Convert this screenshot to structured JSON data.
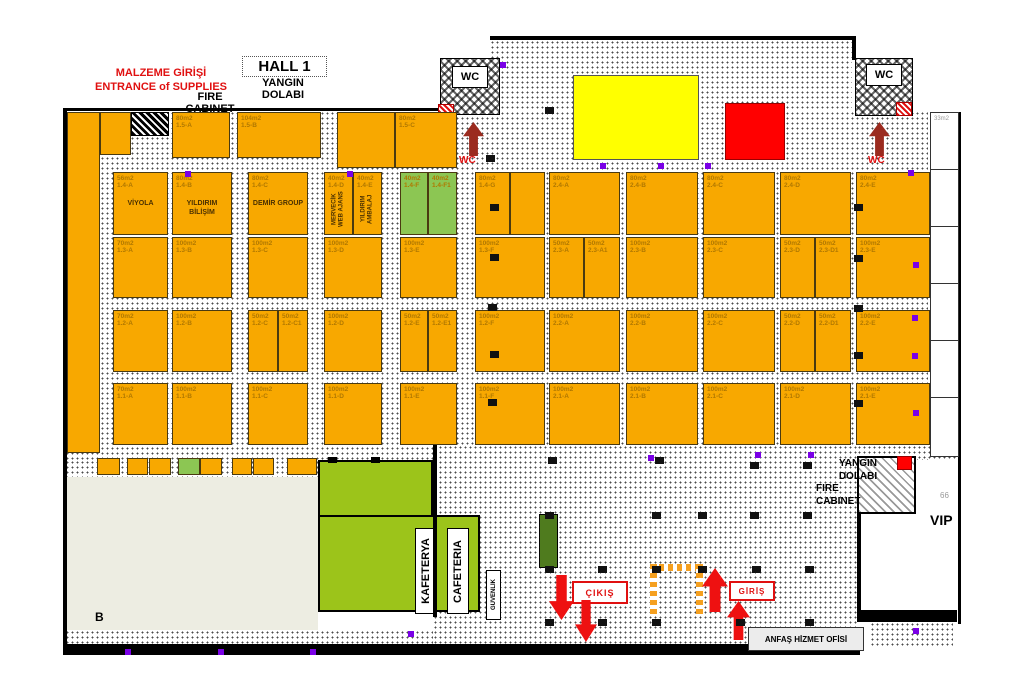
{
  "header": {
    "hall_title": "HALL 1",
    "yangin": "YANGIN",
    "dolabi": "DOLABI",
    "malzeme_line1": "MALZEME GİRİŞİ",
    "malzeme_line2": "ENTRANCE of SUPPLIES",
    "fire_line1": "FIRE",
    "fire_line2": "CABINET"
  },
  "labels": {
    "wc_left": "WC",
    "wc_right": "WC",
    "wc_red_left": "WC",
    "wc_red_right": "WC",
    "yangin_br_1": "YANGIN",
    "yangin_br_2": "DOLABI",
    "yangin_br_3": "FIRE",
    "yangin_br_4": "CABINET",
    "vip": "VIP",
    "dim_66": "66",
    "room_33": "33m2",
    "cikis": "ÇIKIŞ",
    "giris": "GİRİŞ",
    "kafeterya": "KAFETERYA",
    "cafeteria": "CAFETERIA",
    "guvenlik": "GÜVENLİK",
    "anfas_office": "ANFAŞ HİZMET OFİSİ",
    "section_b": "B"
  },
  "colors": {
    "booth_orange": "#F8A800",
    "booth_green": "#8CC653",
    "cafeteria_green": "#9CC41A",
    "kiosk_green": "#4F7B1E",
    "beige_hall": "#EDEDE2",
    "yellow_block": "#FFFF00",
    "red_block": "#FF0000",
    "arrow_red": "#EE1111",
    "arrow_darkred": "#9B2B1F",
    "purple_marker": "#7A00E6"
  },
  "booths": [
    {
      "x": 67,
      "y": 112,
      "w": 33,
      "h": 341
    },
    {
      "x": 100,
      "y": 112,
      "w": 31,
      "h": 43
    },
    {
      "x": 172,
      "y": 112,
      "w": 58,
      "h": 46,
      "size": "80m2",
      "code": "1.5-A"
    },
    {
      "x": 237,
      "y": 112,
      "w": 84,
      "h": 46,
      "size": "104m2",
      "code": "1.5-B"
    },
    {
      "x": 337,
      "y": 112,
      "w": 58,
      "h": 56
    },
    {
      "x": 395,
      "y": 112,
      "w": 62,
      "h": 56,
      "size": "80m2",
      "code": "1.5-C"
    },
    {
      "x": 113,
      "y": 172,
      "w": 55,
      "h": 63,
      "size": "56m2",
      "code": "1.4-A",
      "name": "VİYOLA"
    },
    {
      "x": 172,
      "y": 172,
      "w": 60,
      "h": 63,
      "size": "80m2",
      "code": "1.4-B",
      "name": "YILDIRIM BİLİŞİM"
    },
    {
      "x": 248,
      "y": 172,
      "w": 60,
      "h": 63,
      "size": "80m2",
      "code": "1.4-C",
      "name": "DEMİR GROUP"
    },
    {
      "x": 324,
      "y": 172,
      "w": 29,
      "h": 63,
      "size": "40m2",
      "code": "1.4-D",
      "name": "MERVECİK WEB AJANS",
      "vert": true
    },
    {
      "x": 353,
      "y": 172,
      "w": 29,
      "h": 63,
      "size": "40m2",
      "code": "1.4-E",
      "name": "YILDIRIM AMBALAJ",
      "vert": true
    },
    {
      "x": 400,
      "y": 172,
      "w": 28,
      "h": 63,
      "size": "40m2",
      "code": "1.4-F",
      "green": true
    },
    {
      "x": 428,
      "y": 172,
      "w": 29,
      "h": 63,
      "size": "40m2",
      "code": "1.4-F1",
      "green": true
    },
    {
      "x": 475,
      "y": 172,
      "w": 35,
      "h": 63,
      "size": "80m2",
      "code": "1.4-G"
    },
    {
      "x": 510,
      "y": 172,
      "w": 35,
      "h": 63
    },
    {
      "x": 549,
      "y": 172,
      "w": 71,
      "h": 63,
      "size": "80m2",
      "code": "2.4-A"
    },
    {
      "x": 626,
      "y": 172,
      "w": 72,
      "h": 63,
      "size": "80m2",
      "code": "2.4-B"
    },
    {
      "x": 703,
      "y": 172,
      "w": 72,
      "h": 63,
      "size": "80m2",
      "code": "2.4-C"
    },
    {
      "x": 780,
      "y": 172,
      "w": 71,
      "h": 63,
      "size": "80m2",
      "code": "2.4-D"
    },
    {
      "x": 856,
      "y": 172,
      "w": 74,
      "h": 63,
      "size": "80m2",
      "code": "2.4-E"
    },
    {
      "x": 113,
      "y": 237,
      "w": 55,
      "h": 61,
      "size": "70m2",
      "code": "1.3-A"
    },
    {
      "x": 172,
      "y": 237,
      "w": 60,
      "h": 61,
      "size": "100m2",
      "code": "1.3-B"
    },
    {
      "x": 248,
      "y": 237,
      "w": 60,
      "h": 61,
      "size": "100m2",
      "code": "1.3-C"
    },
    {
      "x": 324,
      "y": 237,
      "w": 58,
      "h": 61,
      "size": "100m2",
      "code": "1.3-D"
    },
    {
      "x": 400,
      "y": 237,
      "w": 57,
      "h": 61,
      "size": "100m2",
      "code": "1.3-E"
    },
    {
      "x": 475,
      "y": 237,
      "w": 70,
      "h": 61,
      "size": "100m2",
      "code": "1.3-F"
    },
    {
      "x": 549,
      "y": 237,
      "w": 35,
      "h": 61,
      "size": "50m2",
      "code": "2.3-A"
    },
    {
      "x": 584,
      "y": 237,
      "w": 36,
      "h": 61,
      "size": "50m2",
      "code": "2.3-A1"
    },
    {
      "x": 626,
      "y": 237,
      "w": 72,
      "h": 61,
      "size": "100m2",
      "code": "2.3-B"
    },
    {
      "x": 703,
      "y": 237,
      "w": 72,
      "h": 61,
      "size": "100m2",
      "code": "2.3-C"
    },
    {
      "x": 780,
      "y": 237,
      "w": 35,
      "h": 61,
      "size": "50m2",
      "code": "2.3-D"
    },
    {
      "x": 815,
      "y": 237,
      "w": 36,
      "h": 61,
      "size": "50m2",
      "code": "2.3-D1"
    },
    {
      "x": 856,
      "y": 237,
      "w": 74,
      "h": 61,
      "size": "100m2",
      "code": "2.3-E"
    },
    {
      "x": 113,
      "y": 310,
      "w": 55,
      "h": 62,
      "size": "70m2",
      "code": "1.2-A"
    },
    {
      "x": 172,
      "y": 310,
      "w": 60,
      "h": 62,
      "size": "100m2",
      "code": "1.2-B"
    },
    {
      "x": 248,
      "y": 310,
      "w": 30,
      "h": 62,
      "size": "50m2",
      "code": "1.2-C"
    },
    {
      "x": 278,
      "y": 310,
      "w": 30,
      "h": 62,
      "size": "50m2",
      "code": "1.2-C1"
    },
    {
      "x": 324,
      "y": 310,
      "w": 58,
      "h": 62,
      "size": "100m2",
      "code": "1.2-D"
    },
    {
      "x": 400,
      "y": 310,
      "w": 28,
      "h": 62,
      "size": "50m2",
      "code": "1.2-E"
    },
    {
      "x": 428,
      "y": 310,
      "w": 29,
      "h": 62,
      "size": "50m2",
      "code": "1.2-E1"
    },
    {
      "x": 475,
      "y": 310,
      "w": 70,
      "h": 62,
      "size": "100m2",
      "code": "1.2-F"
    },
    {
      "x": 549,
      "y": 310,
      "w": 71,
      "h": 62,
      "size": "100m2",
      "code": "2.2-A"
    },
    {
      "x": 626,
      "y": 310,
      "w": 72,
      "h": 62,
      "size": "100m2",
      "code": "2.2-B"
    },
    {
      "x": 703,
      "y": 310,
      "w": 72,
      "h": 62,
      "size": "100m2",
      "code": "2.2-C"
    },
    {
      "x": 780,
      "y": 310,
      "w": 35,
      "h": 62,
      "size": "50m2",
      "code": "2.2-D"
    },
    {
      "x": 815,
      "y": 310,
      "w": 36,
      "h": 62,
      "size": "50m2",
      "code": "2.2-D1"
    },
    {
      "x": 856,
      "y": 310,
      "w": 74,
      "h": 62,
      "size": "100m2",
      "code": "2.2-E"
    },
    {
      "x": 113,
      "y": 383,
      "w": 55,
      "h": 62,
      "size": "70m2",
      "code": "1.1-A"
    },
    {
      "x": 172,
      "y": 383,
      "w": 60,
      "h": 62,
      "size": "100m2",
      "code": "1.1-B"
    },
    {
      "x": 248,
      "y": 383,
      "w": 60,
      "h": 62,
      "size": "100m2",
      "code": "1.1-C"
    },
    {
      "x": 324,
      "y": 383,
      "w": 58,
      "h": 62,
      "size": "100m2",
      "code": "1.1-D"
    },
    {
      "x": 400,
      "y": 383,
      "w": 57,
      "h": 62,
      "size": "100m2",
      "code": "1.1-E"
    },
    {
      "x": 475,
      "y": 383,
      "w": 70,
      "h": 62,
      "size": "100m2",
      "code": "1.1-F"
    },
    {
      "x": 549,
      "y": 383,
      "w": 71,
      "h": 62,
      "size": "100m2",
      "code": "2.1-A"
    },
    {
      "x": 626,
      "y": 383,
      "w": 72,
      "h": 62,
      "size": "100m2",
      "code": "2.1-B"
    },
    {
      "x": 703,
      "y": 383,
      "w": 72,
      "h": 62,
      "size": "100m2",
      "code": "2.1-C"
    },
    {
      "x": 780,
      "y": 383,
      "w": 71,
      "h": 62,
      "size": "100m2",
      "code": "2.1-D"
    },
    {
      "x": 856,
      "y": 383,
      "w": 74,
      "h": 62,
      "size": "100m2",
      "code": "2.1-E"
    },
    {
      "x": 97,
      "y": 458,
      "w": 23,
      "h": 17
    },
    {
      "x": 127,
      "y": 458,
      "w": 21,
      "h": 17
    },
    {
      "x": 149,
      "y": 458,
      "w": 22,
      "h": 17
    },
    {
      "x": 178,
      "y": 458,
      "w": 22,
      "h": 17,
      "green": true
    },
    {
      "x": 200,
      "y": 458,
      "w": 22,
      "h": 17
    },
    {
      "x": 232,
      "y": 458,
      "w": 20,
      "h": 17
    },
    {
      "x": 253,
      "y": 458,
      "w": 21,
      "h": 17
    },
    {
      "x": 287,
      "y": 458,
      "w": 30,
      "h": 17
    }
  ],
  "arrows": [
    {
      "x": 549,
      "y": 575,
      "w": 25,
      "h": 45,
      "dir": "down",
      "color": "#EE1111",
      "name": "exit-arrow-down-1"
    },
    {
      "x": 575,
      "y": 600,
      "w": 22,
      "h": 42,
      "dir": "down",
      "color": "#EE1111",
      "name": "exit-arrow-down-2"
    },
    {
      "x": 702,
      "y": 568,
      "w": 26,
      "h": 44,
      "dir": "up",
      "color": "#EE1111",
      "name": "entry-arrow-up-1"
    },
    {
      "x": 727,
      "y": 601,
      "w": 23,
      "h": 39,
      "dir": "up",
      "color": "#EE1111",
      "name": "entry-arrow-up-2"
    },
    {
      "x": 463,
      "y": 122,
      "w": 21,
      "h": 34,
      "dir": "up",
      "color": "#9B2B1F",
      "name": "wc-arrow-left"
    },
    {
      "x": 869,
      "y": 122,
      "w": 21,
      "h": 34,
      "dir": "up",
      "color": "#9B2B1F",
      "name": "wc-arrow-right"
    }
  ],
  "pillars": [
    [
      545,
      107
    ],
    [
      486,
      155
    ],
    [
      490,
      204
    ],
    [
      490,
      254
    ],
    [
      488,
      304
    ],
    [
      490,
      351
    ],
    [
      488,
      399
    ],
    [
      854,
      204
    ],
    [
      854,
      255
    ],
    [
      854,
      305
    ],
    [
      854,
      352
    ],
    [
      854,
      400
    ],
    [
      548,
      457
    ],
    [
      655,
      457
    ],
    [
      750,
      462
    ],
    [
      803,
      462
    ],
    [
      545,
      512
    ],
    [
      652,
      512
    ],
    [
      698,
      512
    ],
    [
      750,
      512
    ],
    [
      803,
      512
    ],
    [
      545,
      566
    ],
    [
      598,
      566
    ],
    [
      652,
      566
    ],
    [
      698,
      566
    ],
    [
      752,
      566
    ],
    [
      805,
      566
    ],
    [
      545,
      619
    ],
    [
      598,
      619
    ],
    [
      652,
      619
    ],
    [
      736,
      619
    ],
    [
      805,
      619
    ]
  ],
  "purple_dots": [
    [
      185,
      171
    ],
    [
      347,
      171
    ],
    [
      500,
      62
    ],
    [
      600,
      163
    ],
    [
      658,
      163
    ],
    [
      705,
      163
    ],
    [
      908,
      170
    ],
    [
      913,
      262
    ],
    [
      912,
      315
    ],
    [
      912,
      353
    ],
    [
      913,
      410
    ],
    [
      648,
      455
    ],
    [
      755,
      452
    ],
    [
      808,
      452
    ],
    [
      913,
      628
    ],
    [
      125,
      649
    ],
    [
      218,
      649
    ],
    [
      310,
      649
    ],
    [
      408,
      631
    ]
  ]
}
